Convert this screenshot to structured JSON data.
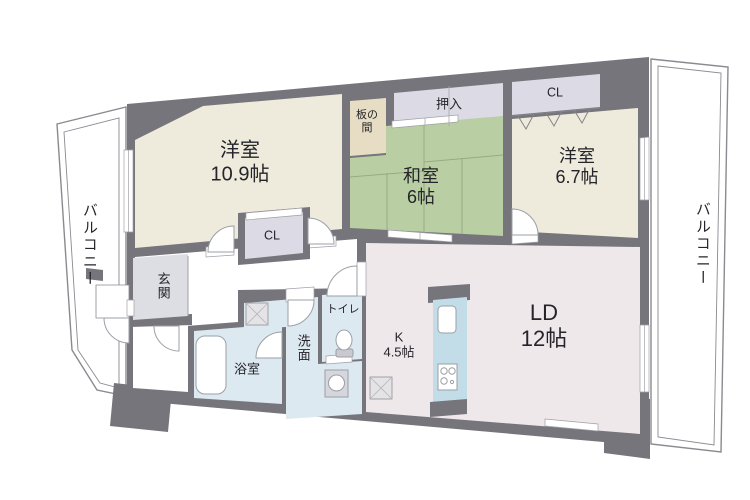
{
  "floorplan": {
    "rooms": {
      "yoshitsu_109": {
        "name": "洋室",
        "size": "10.9帖"
      },
      "washitsu": {
        "name": "和室",
        "size": "6帖"
      },
      "yoshitsu_67": {
        "name": "洋室",
        "size": "6.7帖"
      },
      "living_dining": {
        "name": "LD",
        "size": "12帖"
      },
      "kitchen": {
        "name": "K",
        "size": "4.5帖"
      },
      "itanoma": {
        "name": "板の間"
      },
      "oshiire": {
        "name": "押入"
      },
      "closet_north": {
        "name": "CL"
      },
      "closet_center": {
        "name": "CL"
      },
      "genkan": {
        "name": "玄関"
      },
      "bathroom": {
        "name": "浴室"
      },
      "washroom": {
        "name": "洗面"
      },
      "toilet": {
        "name": "トイレ"
      },
      "balcony_left": {
        "name": "バルコニー"
      },
      "balcony_right": {
        "name": "バルコニー"
      }
    },
    "colors": {
      "wall": "#75757b",
      "western_room": "#eeebdc",
      "tatami": "#b9cfa3",
      "itanoma": "#e7ddc4",
      "closet": "#dcdbe5",
      "ldk": "#efe8eb",
      "wet_area": "#dde9f0",
      "kitchen_counter": "#c2dde8",
      "genkan_floor": "#dddde4",
      "background": "#ffffff"
    }
  }
}
